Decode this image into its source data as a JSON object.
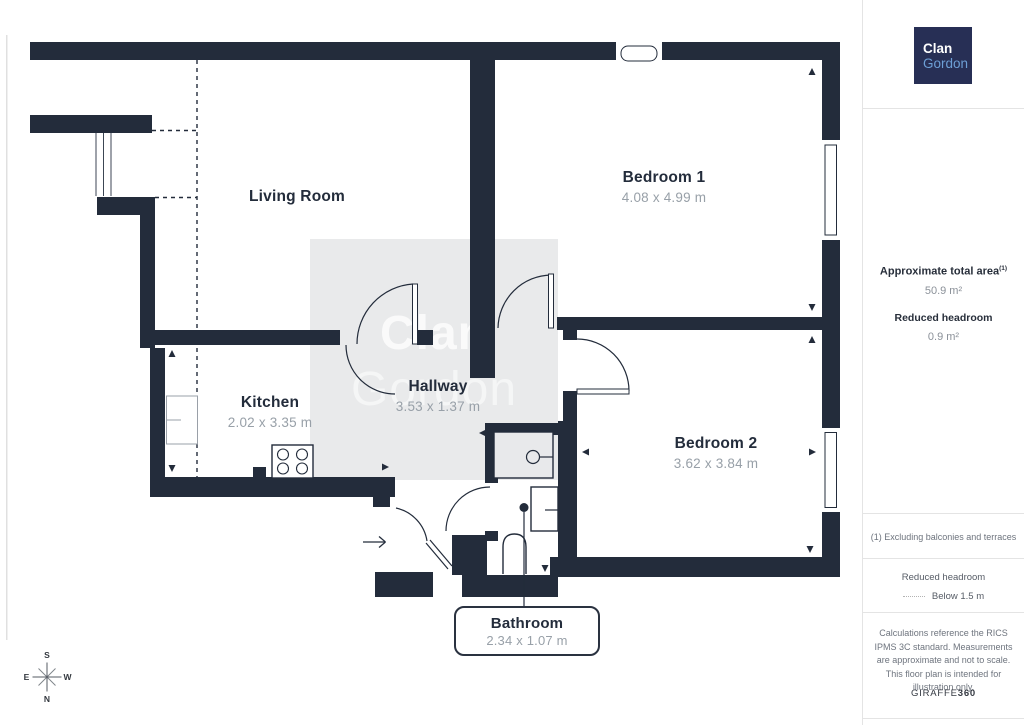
{
  "plan": {
    "rooms": [
      {
        "name": "Living Room",
        "dims": ""
      },
      {
        "name": "Bedroom 1",
        "dims": "4.08 x 4.99 m"
      },
      {
        "name": "Kitchen",
        "dims": "2.02 x 3.35 m"
      },
      {
        "name": "Hallway",
        "dims": "3.53 x 1.37 m"
      },
      {
        "name": "Bedroom 2",
        "dims": "3.62 x 3.84 m"
      },
      {
        "name": "Bathroom",
        "dims": "2.34 x 1.07 m"
      }
    ],
    "watermark": {
      "line1": "Clan",
      "line2": "Gordon"
    },
    "compass": {
      "top": "S",
      "right": "W",
      "bottom": "N",
      "left": "E"
    }
  },
  "sidebar": {
    "logo": {
      "line1": "Clan",
      "line2": "Gordon"
    },
    "summary": {
      "total_area_label": "Approximate total area",
      "total_area_note_ref": "(1)",
      "total_area_value": "50.9 m²",
      "reduced_headroom_label": "Reduced headroom",
      "reduced_headroom_value": "0.9 m²"
    },
    "footnote": "(1) Excluding balconies and terraces",
    "legend": {
      "title": "Reduced headroom",
      "item_label": "Below 1.5 m"
    },
    "disclaimer": "Calculations reference the RICS IPMS 3C standard. Measurements are approximate and not to scale. This floor plan is intended for illustration only.",
    "brand": {
      "name": "GIRAFFE",
      "suffix": "360"
    }
  },
  "colors": {
    "wall": "#232c3b",
    "watermark_bg": "#e9eaeb",
    "logo_bg": "#272f55",
    "logo_accent": "#6d9fd6",
    "room_dims_text": "#98a0a8",
    "muted_text": "#6e747e"
  }
}
